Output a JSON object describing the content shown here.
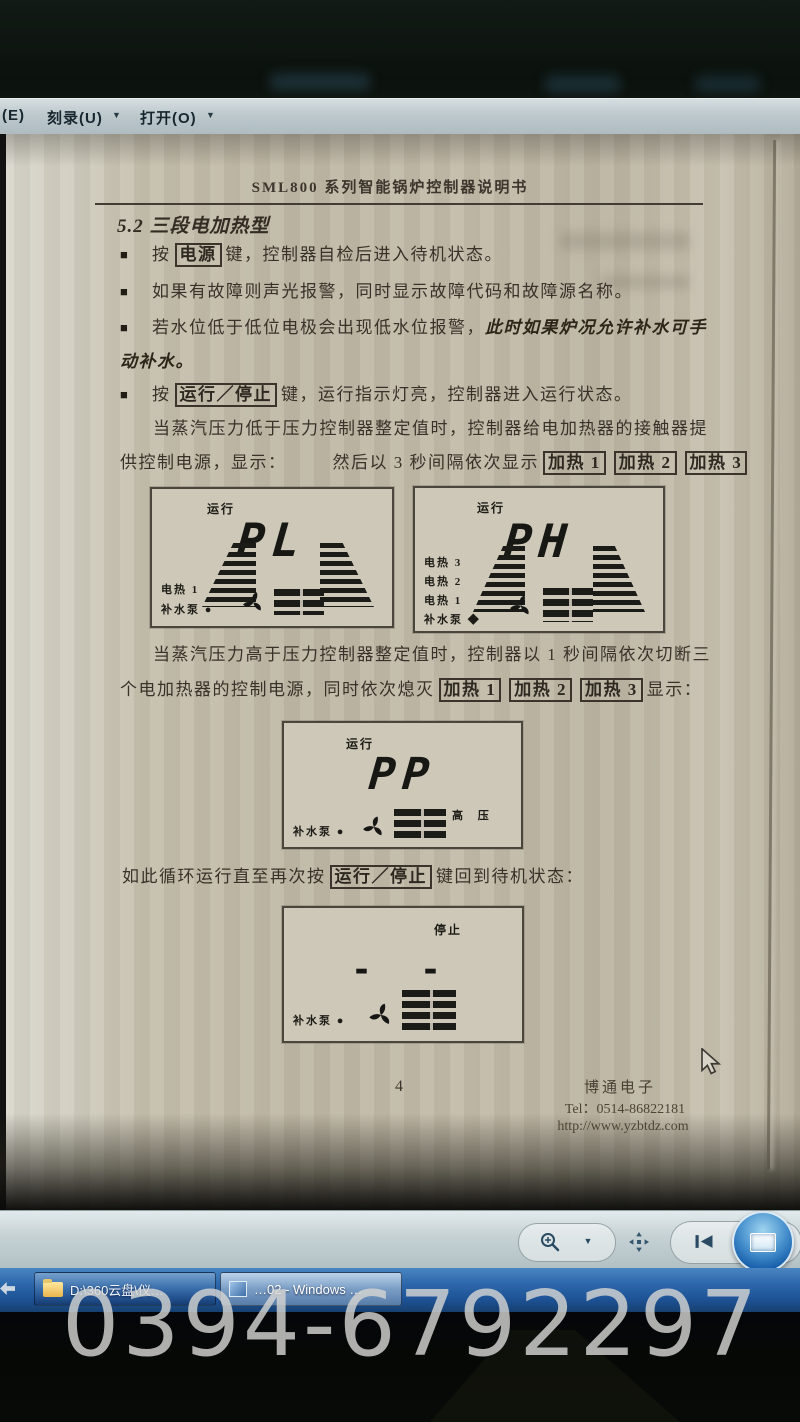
{
  "menubar": {
    "partial_left": "(E)",
    "burn": "刻录(U)",
    "open": "打开(O)",
    "dropdown_glyph": "▼"
  },
  "doc": {
    "title": "SML800 系列智能锅炉控制器说明书",
    "heading": "5.2 三段电加热型",
    "bullet_glyph": "■",
    "b1_pre": "按",
    "b1_key": "电源",
    "b1_post": "键，控制器自检后进入待机状态。",
    "b2": "如果有故障则声光报警，同时显示故障代码和故障源名称。",
    "b3_pre": "若水位低于低位电极会出现低水位报警，",
    "b3_em": "此时如果炉况允许补水可手",
    "b3_em2": "动补水。",
    "b4_pre": "按",
    "b4_key": "运行／停止",
    "b4_post": "键，运行指示灯亮，控制器进入运行状态。",
    "p1_l1": "当蒸汽压力低于压力控制器整定值时，控制器给电加热器的接触器提",
    "p1_l2a": "供控制电源，显示：",
    "p1_l2b": "然后以 3 秒间隔依次显示",
    "heat1": "加热 1",
    "heat2": "加热 2",
    "heat3": "加热 3",
    "p2_l1": "当蒸汽压力高于压力控制器整定值时，控制器以 1 秒间隔依次切断三",
    "p2_l2a": "个电加热器的控制电源，同时依次熄灭",
    "p2_l2b": "显示：",
    "p3_a": "如此循环运行直至再次按",
    "p3_key": "运行／停止",
    "p3_b": "键回到待机状态：",
    "page_num": "4",
    "company": "博通电子",
    "tel": "Tel：0514-86822181",
    "url": "http://www.yzbtdz.com"
  },
  "lcd": {
    "p1": {
      "status": "运行",
      "digits": "PL",
      "l1": "电热 1",
      "l2": "补水泵 ●"
    },
    "p2": {
      "status": "运行",
      "digits": "PH",
      "l1": "电热 3",
      "l2": "电热 2",
      "l3": "电热 1",
      "l4": "补水泵 ◆"
    },
    "p3": {
      "status": "运行",
      "digits": "PP",
      "right": "高 压",
      "l1": "补水泵 ●"
    },
    "p4": {
      "status": "停止",
      "digits": "- -",
      "l1": "补水泵 ●"
    }
  },
  "taskbar": {
    "item1": "D:\\360云盘\\仪…",
    "item2": "…02 - Windows …"
  },
  "watermark": "0394-6792297",
  "colors": {
    "taskbar_blue": "#2a66ad",
    "paper": "#c2bbaa",
    "accent_blue": "#1565b8"
  }
}
